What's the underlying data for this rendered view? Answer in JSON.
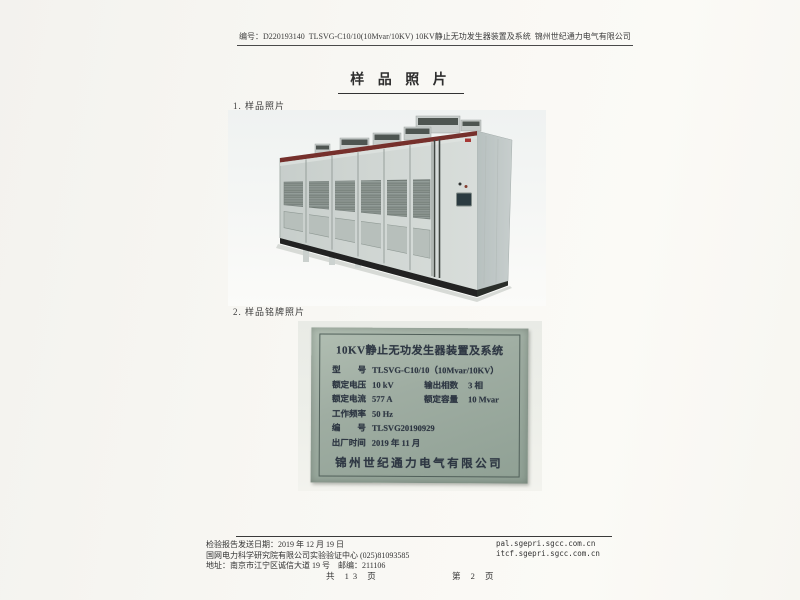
{
  "header": {
    "report_no": "编号：D220193140",
    "doc_title": "TLSVG-C10/10(10Mvar/10KV) 10KV静止无功发生器装置及系统",
    "company": "锦州世纪通力电气有限公司"
  },
  "body": {
    "page_title": "样 品 照 片",
    "item1_label": "1.  样品照片",
    "item2_label": "2.  样品铭牌照片"
  },
  "nameplate": {
    "title": "10KV静止无功发生器装置及系统",
    "rows": [
      {
        "label": "型　　号",
        "value": "TLSVG-C10/10（10Mvar/10KV）"
      },
      {
        "label": "额定电压",
        "value": "10 kV",
        "label2": "输出相数",
        "value2": "3 相"
      },
      {
        "label": "额定电流",
        "value": "577 A",
        "label2": "额定容量",
        "value2": "10 Mvar"
      },
      {
        "label": "工作频率",
        "value": "50 Hz"
      },
      {
        "label": "编　　号",
        "value": "TLSVG20190929"
      },
      {
        "label": "出厂时间",
        "value": "2019 年 11 月"
      }
    ],
    "company": "锦州世纪通力电气有限公司"
  },
  "footer": {
    "sent_date": "检验报告发送日期：2019 年 12 月 19 日",
    "org": "国网电力科学研究院有限公司实验验证中心 (025)81093585",
    "address": "地址：南京市江宁区诚信大道 19 号　邮编：211106",
    "email1": "pal.sgepri.sgcc.com.cn",
    "email2": "itcf.sgepri.sgcc.com.cn",
    "total_pages": "共 13 页",
    "page_no": "第 2 页"
  },
  "colors": {
    "paper": "#f8f7f3",
    "plate_green": "#9fada2",
    "cabinet_gray": "#ccd3d0",
    "trim_red": "#7c2e29",
    "base_black": "#202422"
  }
}
